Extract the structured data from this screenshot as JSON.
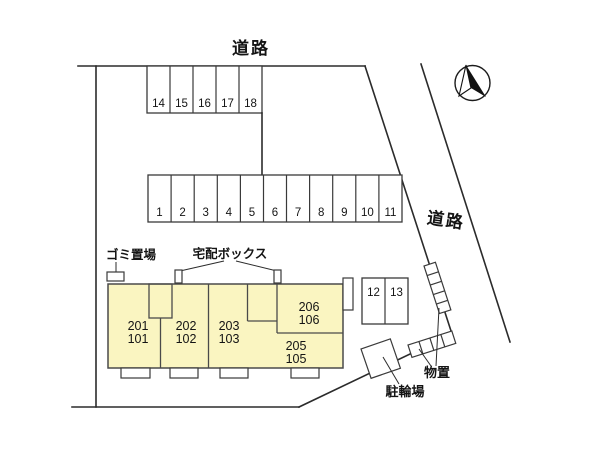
{
  "colors": {
    "background": "#ffffff",
    "building_fill": "#faf5c1",
    "line": "#2b2b2b"
  },
  "roads": {
    "top_label": "道路",
    "right_label": "道路"
  },
  "parking": {
    "top_row": {
      "spaces": [
        "14",
        "15",
        "16",
        "17",
        "18"
      ]
    },
    "main_row": {
      "spaces": [
        "1",
        "2",
        "3",
        "4",
        "5",
        "6",
        "7",
        "8",
        "9",
        "10",
        "11"
      ]
    },
    "side_row": {
      "spaces": [
        "12",
        "13"
      ]
    }
  },
  "building": {
    "units": [
      {
        "upper": "201",
        "lower": "101"
      },
      {
        "upper": "202",
        "lower": "102"
      },
      {
        "upper": "203",
        "lower": "103"
      },
      {
        "upper": "206",
        "lower": "106"
      },
      {
        "upper": "205",
        "lower": "105"
      }
    ]
  },
  "facilities": {
    "garbage_label": "ゴミ置場",
    "delivery_box_label": "宅配ボックス",
    "storage_label": "物置",
    "bicycle_parking_label": "駐輪場"
  }
}
